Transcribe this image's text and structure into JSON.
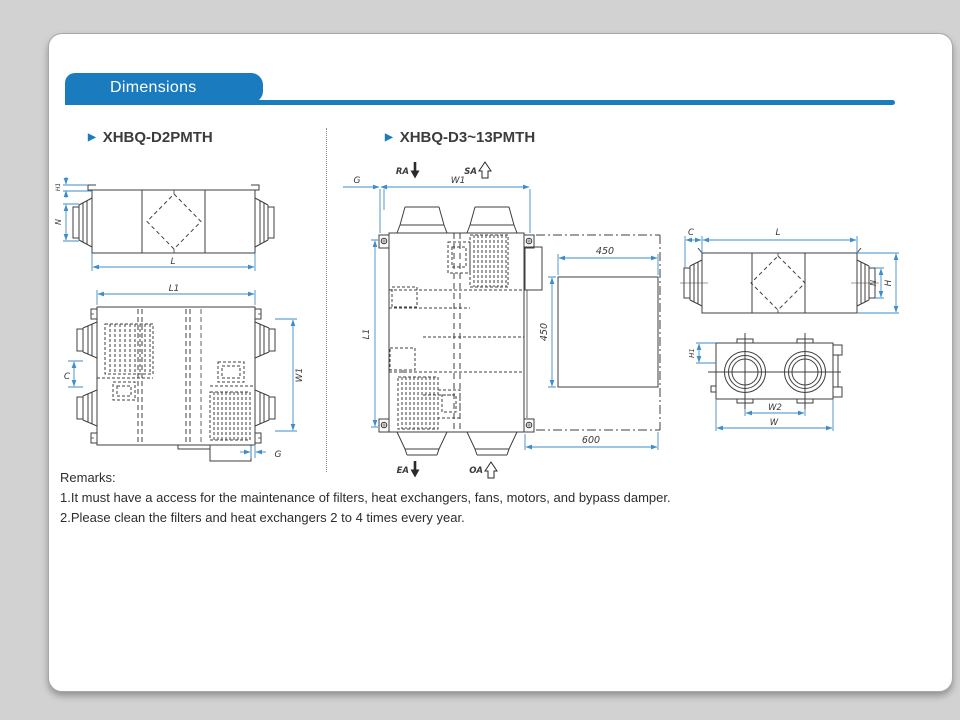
{
  "header": {
    "title": "Dimensions"
  },
  "sections": {
    "left": {
      "title": "XHBQ-D2PMTH"
    },
    "right": {
      "title": "XHBQ-D3~13PMTH"
    }
  },
  "remarks": {
    "heading": "Remarks:",
    "lines": [
      "1.It must have a access for the maintenance of filters, heat exchangers, fans, motors, and bypass damper.",
      "2.Please clean the filters and heat exchangers 2 to 4 times every year."
    ]
  },
  "colors": {
    "accent": "#1a7bbf",
    "dimension_line": "#3e8ec9",
    "drawing_line": "#3f3f3f",
    "backdrop": "#d2d2d2"
  },
  "drawings": {
    "d2_side": {
      "h1": "H1",
      "n": "N",
      "l": "L"
    },
    "d2_top": {
      "l1": "L1",
      "w1": "W1",
      "c": "C",
      "g": "G"
    },
    "d3_top": {
      "ra": "RA",
      "sa": "SA",
      "ea": "EA",
      "oa": "OA",
      "g": "G",
      "w1": "W1",
      "l1": "L1",
      "space_width": "450",
      "space_height": "450",
      "space_total": "600"
    },
    "d3_side": {
      "c": "C",
      "l": "L",
      "n": "N",
      "h": "H"
    },
    "d3_end": {
      "h1": "H1",
      "w2": "W2",
      "w": "W"
    }
  }
}
